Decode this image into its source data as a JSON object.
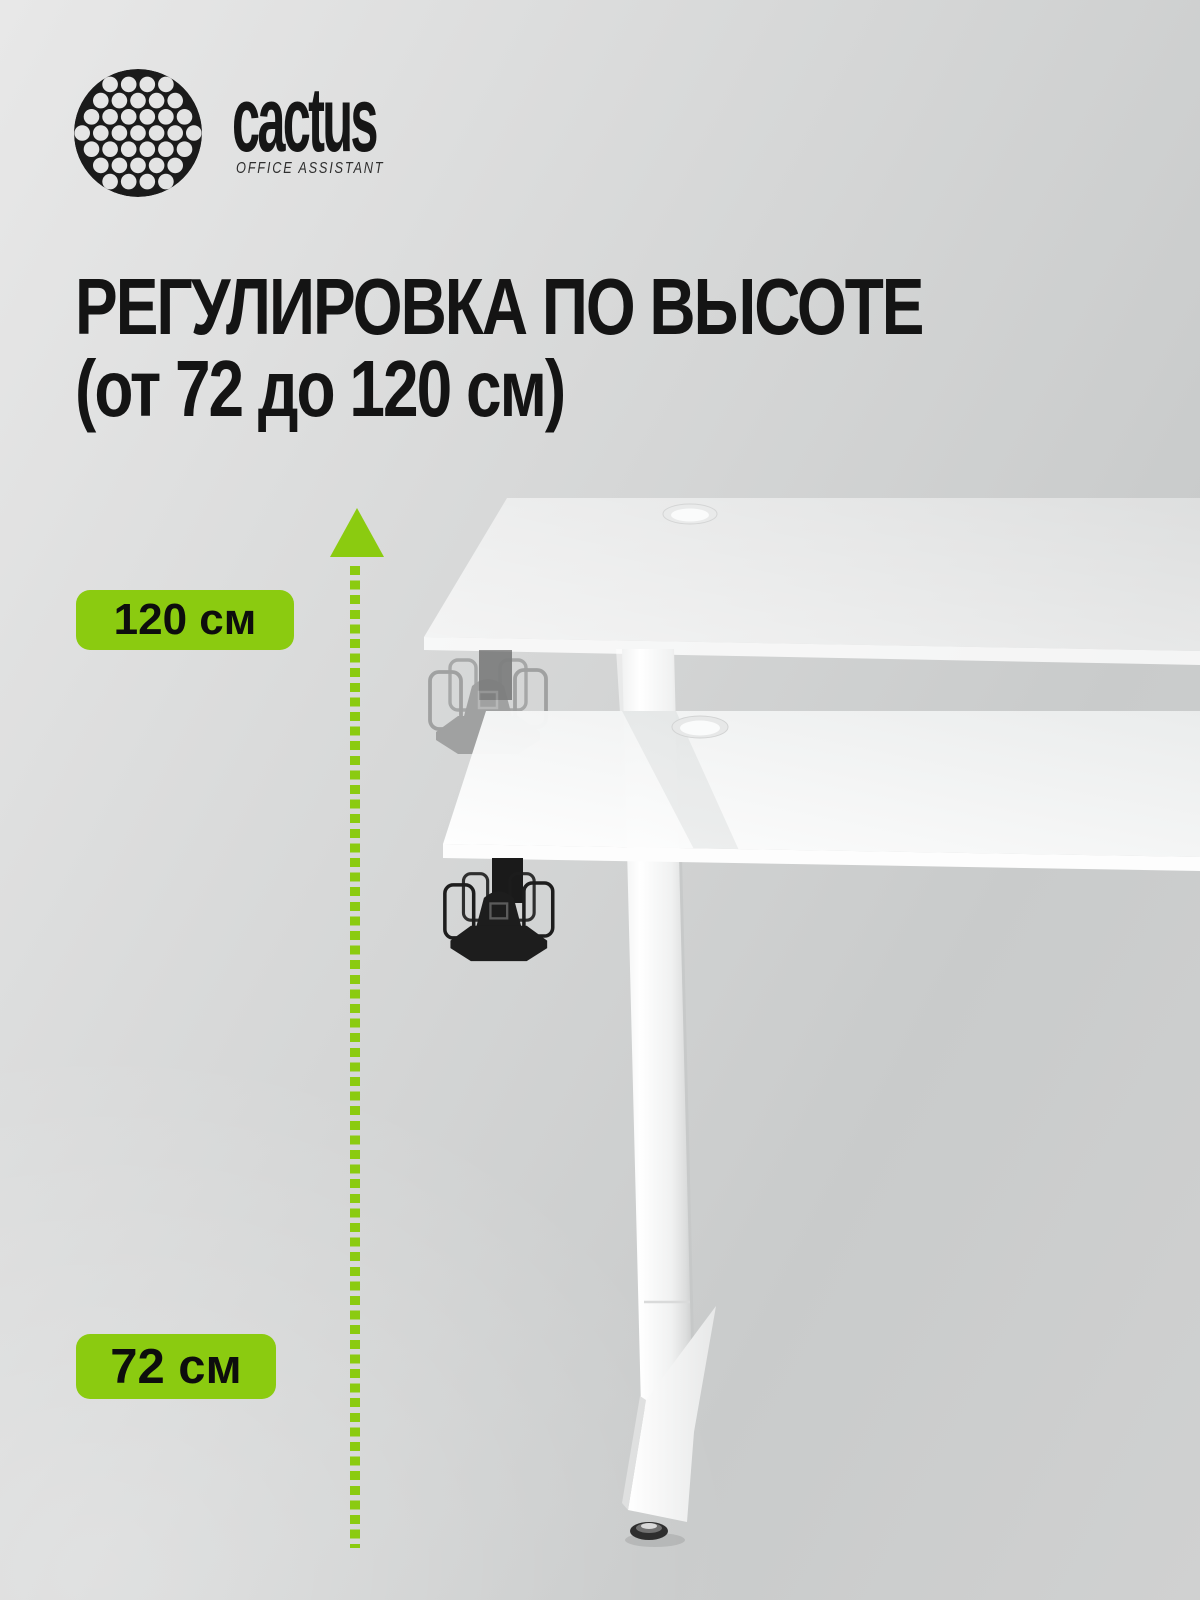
{
  "brand": {
    "name": "cactus",
    "tagline": "OFFICE ASSISTANT",
    "logo_icon": "cactus-dots-circle"
  },
  "heading": {
    "line1": "РЕГУЛИРОВКА ПО ВЫСОТЕ",
    "line2": "(от 72 до 120 см)"
  },
  "badges": {
    "max_height": "120 см",
    "min_height": "72 см"
  },
  "icons": {
    "arrow": "height-range-arrow-up",
    "illustration": "height-adjustable-desk-two-positions"
  },
  "colors": {
    "accent_green": "#8BCB10",
    "text_black": "#141414",
    "background_gray": "#D2D3D3",
    "desk_white": "#F4F4F4",
    "basket_black": "#1D1D1D"
  },
  "height_range": {
    "min_cm": 72,
    "max_cm": 120
  }
}
